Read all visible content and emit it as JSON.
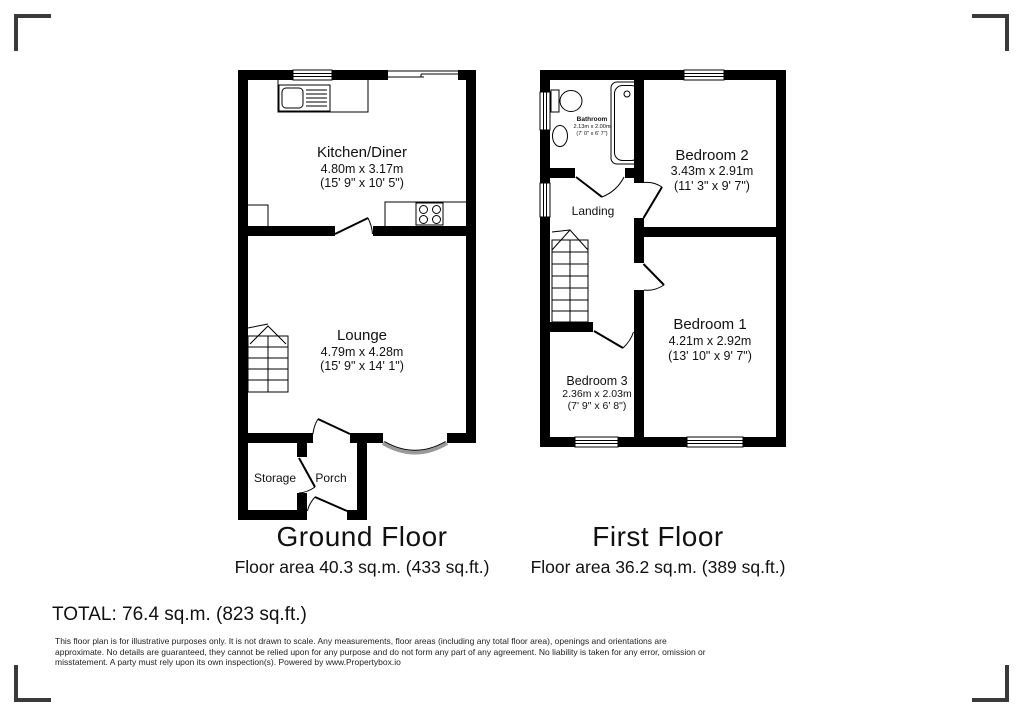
{
  "ground_floor": {
    "title": "Ground Floor",
    "area": "Floor area 40.3 sq.m. (433 sq.ft.)",
    "rooms": {
      "kitchen": {
        "name": "Kitchen/Diner",
        "metric": "4.80m x 3.17m",
        "imperial": "(15' 9\" x 10' 5\")"
      },
      "lounge": {
        "name": "Lounge",
        "metric": "4.79m x 4.28m",
        "imperial": "(15' 9\" x 14' 1\")"
      },
      "storage": {
        "name": "Storage"
      },
      "porch": {
        "name": "Porch"
      }
    }
  },
  "first_floor": {
    "title": "First Floor",
    "area": "Floor area 36.2 sq.m. (389 sq.ft.)",
    "rooms": {
      "bathroom": {
        "name": "Bathroom",
        "metric": "2.13m x 2.00m",
        "imperial": "(7' 0\" x 6' 7\")"
      },
      "bedroom2": {
        "name": "Bedroom 2",
        "metric": "3.43m x 2.91m",
        "imperial": "(11' 3\" x 9' 7\")"
      },
      "landing": {
        "name": "Landing"
      },
      "bedroom1": {
        "name": "Bedroom 1",
        "metric": "4.21m x 2.92m",
        "imperial": "(13' 10\" x 9' 7\")"
      },
      "bedroom3": {
        "name": "Bedroom 3",
        "metric": "2.36m x 2.03m",
        "imperial": "(7' 9\" x 6' 8\")"
      }
    }
  },
  "total_label": "TOTAL: 76.4 sq.m. (823 sq.ft.)",
  "disclaimer": "This floor plan is for illustrative purposes only. It is not drawn to scale. Any measurements, floor areas (including any total floor area), openings and orientations are approximate. No details are guaranteed, they cannot be relied upon for any purpose and do not form any part of any agreement. No liability is taken for any error, omission or misstatement. A party must rely upon its own inspection(s). Powered by www.Propertybox.io",
  "colors": {
    "wall": "#000000",
    "bay_window": "#999999",
    "corner_mark": "#3a3a3a",
    "text": "#111111"
  }
}
